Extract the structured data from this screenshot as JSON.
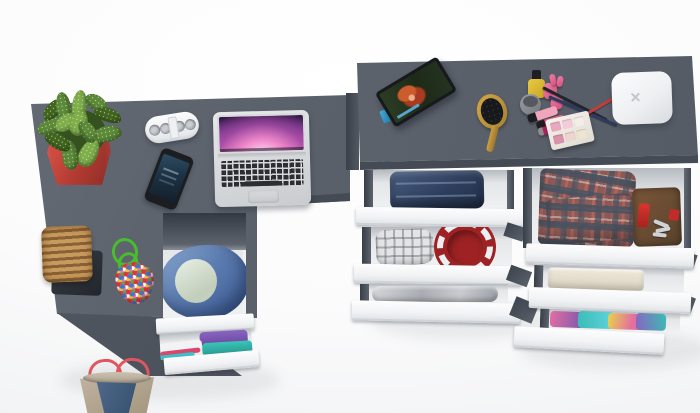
{
  "scene": {
    "type": "3d-render-top-view",
    "description": "Top-down render of a dark gray corner desk and dresser with open white drawers full of clothes and accessories on a white floor",
    "palette": {
      "desk_gray": "#5a616b",
      "desk_edge": "#454b54",
      "drawer_front_white": "#f3f4f6",
      "drawer_interior": "#e9ebed",
      "floor": "#ffffff"
    },
    "left_desk": {
      "label": "dark gray L-shaped desk top",
      "items": [
        {
          "name": "potted-plant",
          "label": "spiky green plant in red square pot",
          "pot_color": "#b23b33",
          "leaf_color": "#5d8a38"
        },
        {
          "name": "portable-speaker",
          "label": "white pill speaker with four round grilles",
          "color": "#f2f4f5"
        },
        {
          "name": "smartphone",
          "label": "black smartphone with dark blue screen on",
          "body_color": "#1b1d20",
          "screen_color": "#1c3244"
        },
        {
          "name": "laptop",
          "label": "open silver laptop with purple aurora wallpaper and black keyboard",
          "body_color": "#d6d8da",
          "wallpaper_colors": [
            "#2a1640",
            "#b853a8",
            "#f48ccd"
          ]
        },
        {
          "name": "wicker-basket",
          "label": "tan wicker basket on dark tray",
          "color": "#b08046",
          "tray_color": "#2c3137"
        },
        {
          "name": "bead-charm",
          "label": "green cord charm covered in multicolored beads",
          "cord_color": "#49bd2e",
          "bead_base_color": "#c2566e"
        }
      ],
      "drawer_unit": {
        "label": "under-desk drawer unit with open top drawer",
        "open_drawer_contents": [
          {
            "name": "blue-hoodie",
            "label": "blue hooded jacket wrapped around a light garment",
            "color": "#4a6ea8"
          },
          {
            "name": "light-garment",
            "label": "white-green folded garment",
            "color": "#dfe8dc"
          }
        ],
        "lower_drawer_contents": [
          {
            "name": "purple-shirt",
            "color": "#7a55b0"
          },
          {
            "name": "teal-shirt",
            "color": "#2fb3a8"
          },
          {
            "name": "pink-strip",
            "color": "#d8486e"
          }
        ]
      },
      "floor_item": {
        "name": "denim-tote-bag",
        "label": "beige tote bag with denim panel and red rope handles",
        "body_color": "#b5a896",
        "denim_color": "#3f5a78",
        "handle_color": "#e0555e"
      }
    },
    "right_dresser": {
      "label": "dark gray dresser with two columns of open white drawers",
      "surface_items": [
        {
          "name": "tablet",
          "label": "tablet propped on blue stand showing a red-haired cartoon character",
          "frame_color": "#17191c",
          "stand_color": "#45b1e0"
        },
        {
          "name": "hairbrush",
          "label": "gold oval hairbrush with black cushion pad",
          "color": "#c29a3c"
        },
        {
          "name": "cosmetics-set",
          "label": "nail polishes, lipsticks, crossed makeup pencils and an eyeshadow palette",
          "items": [
            "yellow nail polish with black cap",
            "gray cream jar",
            "pink nail polishes",
            "pink lipsticks",
            "black pencil",
            "navy pencil",
            "red pencil",
            "magenta lip tube",
            "six-pan eyeshadow palette"
          ]
        },
        {
          "name": "white-hub-box",
          "label": "rounded white square box with a small x mark",
          "color": "#eef0f2"
        }
      ],
      "drawer_columns": [
        {
          "position": "left",
          "drawers": [
            {
              "contents": [
                {
                  "name": "folded-jeans",
                  "label": "stack of folded blue jeans",
                  "color": "#2e3f5e"
                }
              ]
            },
            {
              "contents": [
                {
                  "name": "gray-plaid-shirt",
                  "label": "light gray plaid folded shirt",
                  "color": "#e3e4e6"
                },
                {
                  "name": "red-round-plate",
                  "label": "dark red plate with white scalloped rim",
                  "color": "#9e2224"
                }
              ]
            },
            {
              "contents": [
                {
                  "name": "silver-garment",
                  "label": "shiny silver-gray folded garment",
                  "color": "#a9adb3"
                }
              ]
            }
          ]
        },
        {
          "position": "right",
          "drawers": [
            {
              "contents": [
                {
                  "name": "tartan-shirt",
                  "label": "red and gray tartan folded shirt",
                  "color": "#8d5b55"
                },
                {
                  "name": "leather-wallet",
                  "label": "brown leather wallet",
                  "color": "#6b4a33"
                },
                {
                  "name": "swiss-knife",
                  "label": "red pocket knife",
                  "color": "#d8352f"
                },
                {
                  "name": "keys",
                  "label": "bunch of keys",
                  "color": "#cfd3d8"
                },
                {
                  "name": "red-badge",
                  "label": "small red badge",
                  "color": "#c02b2b"
                }
              ]
            },
            {
              "contents": [
                {
                  "name": "beige-towel",
                  "label": "folded beige towel",
                  "color": "#e6e1d3"
                }
              ]
            },
            {
              "contents": [
                {
                  "name": "tie-dye-shirts",
                  "label": "bright teal, purple and pink folded shirts",
                  "colors": [
                    "#3bbcb4",
                    "#7a55b0",
                    "#e36fa0",
                    "#e8d24c"
                  ]
                }
              ]
            }
          ]
        }
      ]
    }
  }
}
